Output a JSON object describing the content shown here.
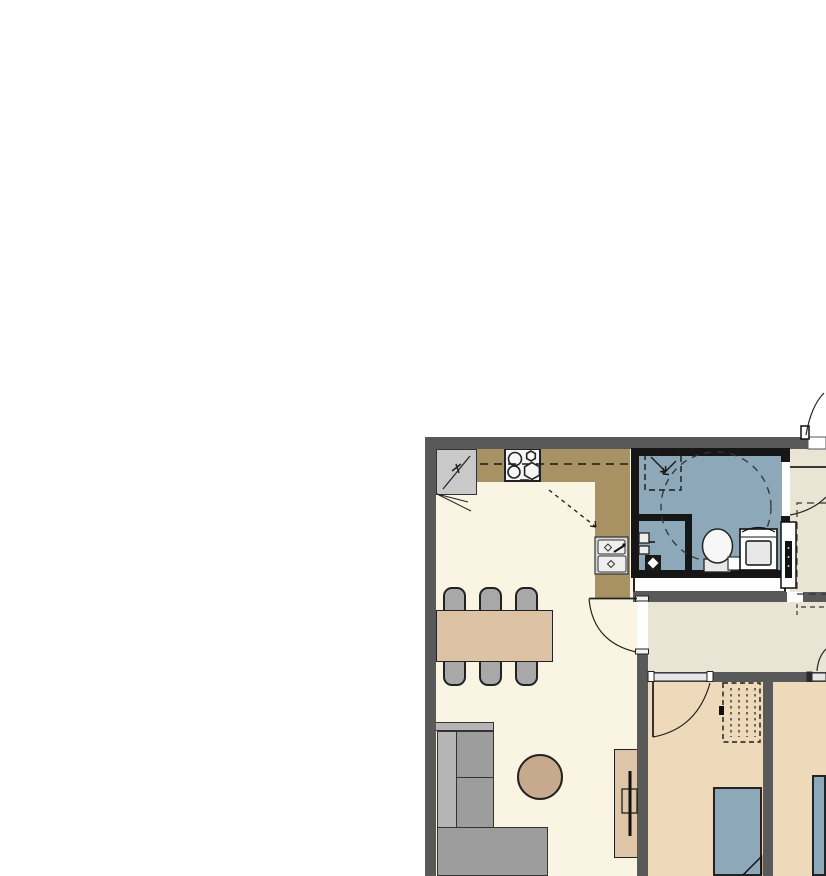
{
  "document": {
    "title": "Apartment floor plan (partial view)",
    "description": "Architectural plan crop showing kitchen, dining area, living room, accessible bathroom, hallway and two bedrooms. No text labels are rendered in the drawing."
  },
  "palette": {
    "canvas_white": "#ffffff",
    "wall_gray": "#595959",
    "wall_black": "#161616",
    "floor_living": "#faf4e3",
    "floor_hall": "#e9e4d4",
    "floor_bedroom": "#eed9bb",
    "floor_bath": "#8da8b8",
    "counter_brown": "#a89163",
    "table_tan": "#dec2a6",
    "chair_gray": "#a8a8a8",
    "sofa_gray": "#9d9d9d",
    "sofa_light": "#b5b5b5",
    "bed_blue": "#8da8b8",
    "appliance_gray": "#c9c9c9",
    "rug_tan": "#c7a98e",
    "cabinet_tan": "#dfc5a8"
  },
  "rooms": [
    {
      "name": "kitchen-dining-living open space",
      "floor": "cream"
    },
    {
      "name": "bathroom",
      "floor": "blue-gray"
    },
    {
      "name": "hallway",
      "floor": "gray-beige"
    },
    {
      "name": "bedroom-1",
      "floor": "tan"
    },
    {
      "name": "bedroom-2",
      "floor": "tan"
    }
  ],
  "fixtures": [
    {
      "name": "refrigerator",
      "room": "kitchen"
    },
    {
      "name": "cooktop-4-burners",
      "room": "kitchen"
    },
    {
      "name": "double-bowl-sink",
      "room": "kitchen"
    },
    {
      "name": "upper-cabinet-dashed-line",
      "room": "kitchen"
    },
    {
      "name": "dining-table",
      "room": "dining"
    },
    {
      "name": "dining-chairs",
      "count": 6,
      "room": "dining"
    },
    {
      "name": "corner-sofa",
      "room": "living"
    },
    {
      "name": "round-coffee-table",
      "room": "living"
    },
    {
      "name": "tv-cabinet-with-tv",
      "room": "living"
    },
    {
      "name": "shower-area-dashed",
      "room": "bathroom"
    },
    {
      "name": "wheelchair-turning-circle-dashed",
      "room": "bathroom"
    },
    {
      "name": "wall-basin",
      "room": "bathroom"
    },
    {
      "name": "floor-drain",
      "room": "bathroom"
    },
    {
      "name": "toilet",
      "room": "bathroom"
    },
    {
      "name": "washing-machine",
      "room": "bathroom"
    },
    {
      "name": "electrical-panel",
      "room": "hallway"
    },
    {
      "name": "dashed-marked-area",
      "room": "hallway"
    },
    {
      "name": "dashed-wardrobe",
      "room": "bedroom-1"
    },
    {
      "name": "bed-with-folded-blanket",
      "room": "bedroom-1"
    },
    {
      "name": "bed",
      "room": "bedroom-2"
    },
    {
      "name": "entry-door-swing",
      "room": "hallway"
    },
    {
      "name": "bathroom-door-swing",
      "room": "hallway"
    },
    {
      "name": "living-room-door-swing",
      "room": "living"
    },
    {
      "name": "bedroom-1-door-swing",
      "room": "bedroom-1"
    },
    {
      "name": "bedroom-2-door-swing",
      "room": "hallway"
    }
  ]
}
